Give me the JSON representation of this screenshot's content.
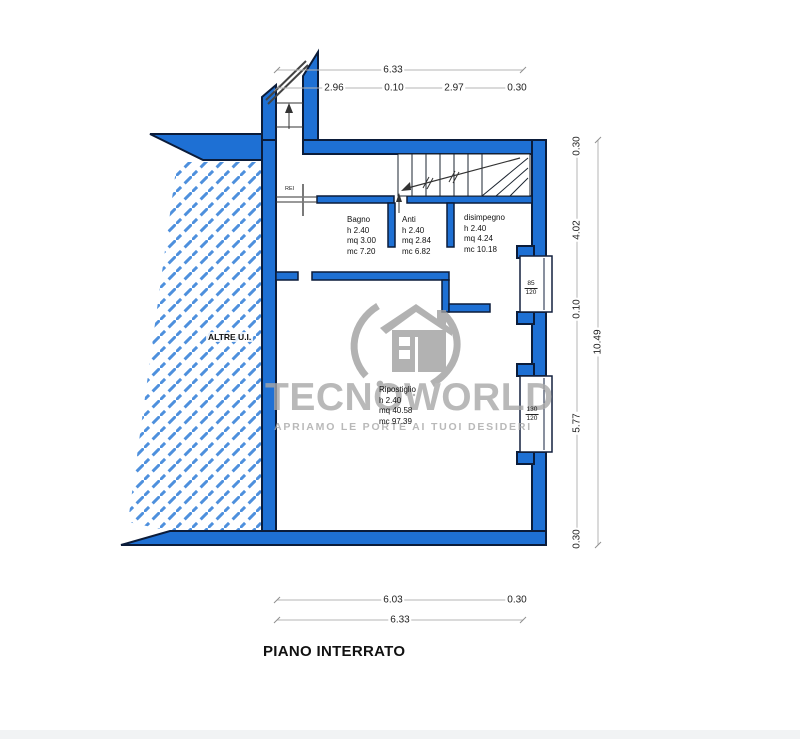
{
  "plan": {
    "title": "PIANO INTERRATO",
    "zone_label": "ALTRE U.I.",
    "door_label": "REI",
    "rooms": [
      {
        "name": "Bagno",
        "l1": "h 2.40",
        "l2": "mq 3.00",
        "l3": "mc 7.20"
      },
      {
        "name": "Anti",
        "l1": "h 2.40",
        "l2": "mq 2.84",
        "l3": "mc 6.82"
      },
      {
        "name": "disimpegno",
        "l1": "h 2.40",
        "l2": "mq 4.24",
        "l3": "mc 10.18"
      },
      {
        "name": "Ripostiglio",
        "l1": "h 2.40",
        "l2": "mq 40.58",
        "l3": "mc 97.39"
      }
    ],
    "windows": [
      {
        "top": "85",
        "bottom": "120"
      },
      {
        "top": "130",
        "bottom": "120"
      }
    ],
    "dims": {
      "top_total": "6.33",
      "top_segments": [
        "2.96",
        "0.10",
        "2.97",
        "0.30"
      ],
      "right_total": "10.49",
      "right_segments": [
        "0.30",
        "4.02",
        "0.10",
        "5.77",
        "0.30"
      ],
      "bottom_segments": [
        "6.03",
        "0.30"
      ],
      "bottom_total": "6.33"
    }
  },
  "watermark": {
    "brand": "TECNOWORLD",
    "tagline": "APRIAMO LE PORTE AI TUOI DESIDERI",
    "logo": "house-orbit-logo"
  },
  "colors": {
    "wall": "#1e70d4",
    "outline": "#0b1c3a",
    "hatch": "#4e90dd",
    "dim": "#b5b5b5",
    "watermark": "#a8a8a8"
  }
}
